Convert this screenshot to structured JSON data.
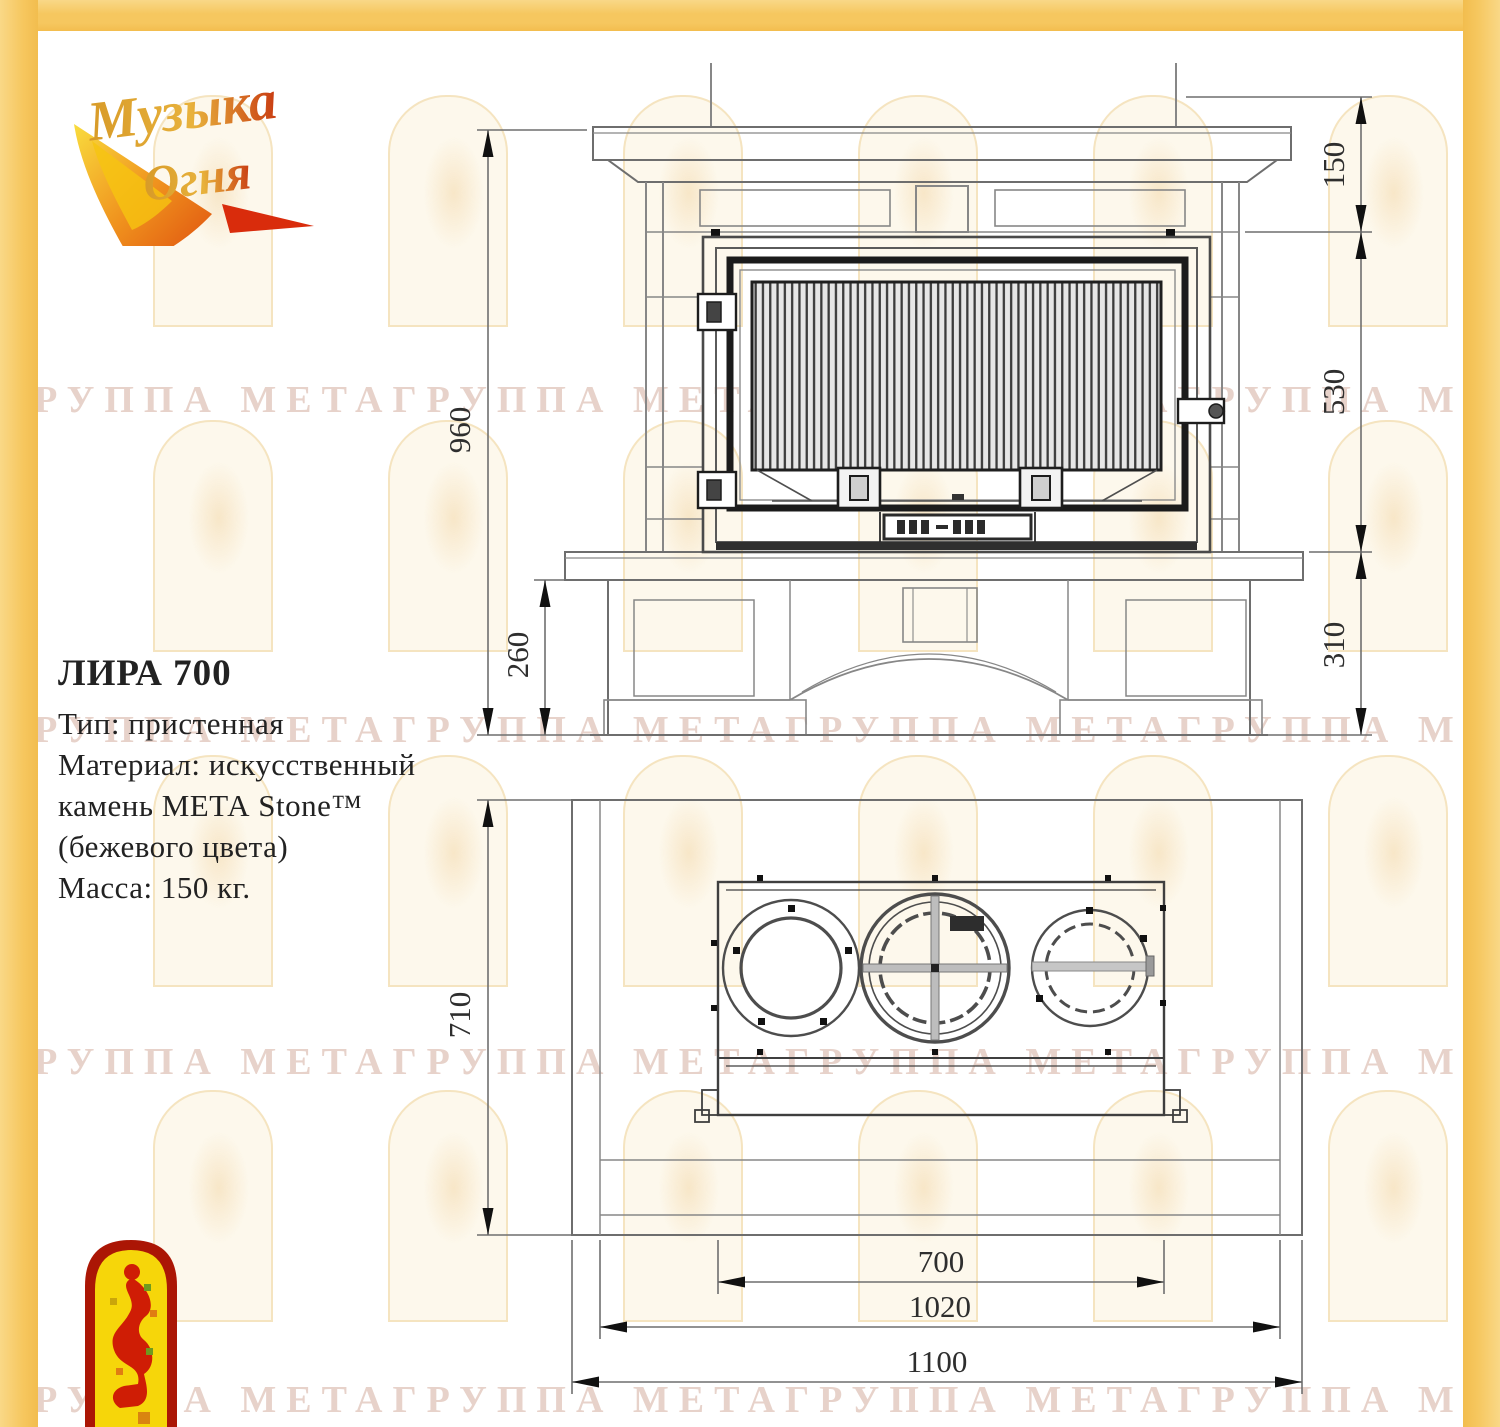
{
  "page": {
    "background": "#ffffff",
    "border_color": "#f6c75f"
  },
  "logo": {
    "line1": "Музыка",
    "line2": "Огня"
  },
  "watermark": {
    "text": "ГРУППА МЕТАГРУППА МЕТАГРУППА МЕТАГРУППА МЕТА"
  },
  "product": {
    "title": "ЛИРА 700",
    "type_line": "Тип: пристенная",
    "material_line1": "Материал: искусственный",
    "material_line2": "камень МЕТА Stone™",
    "material_line3": "(бежевого  цвета)",
    "mass_line": "Масса: 150 кг."
  },
  "drawing": {
    "front_view": {
      "dims": {
        "height_total": "960",
        "hearth_to_floor": "260",
        "top_band": "150",
        "firebox_height": "530",
        "base_height": "310"
      }
    },
    "plan_view": {
      "dims": {
        "depth": "710",
        "firebox_width": "700",
        "inner_width": "1020",
        "total_width": "1100"
      }
    }
  }
}
